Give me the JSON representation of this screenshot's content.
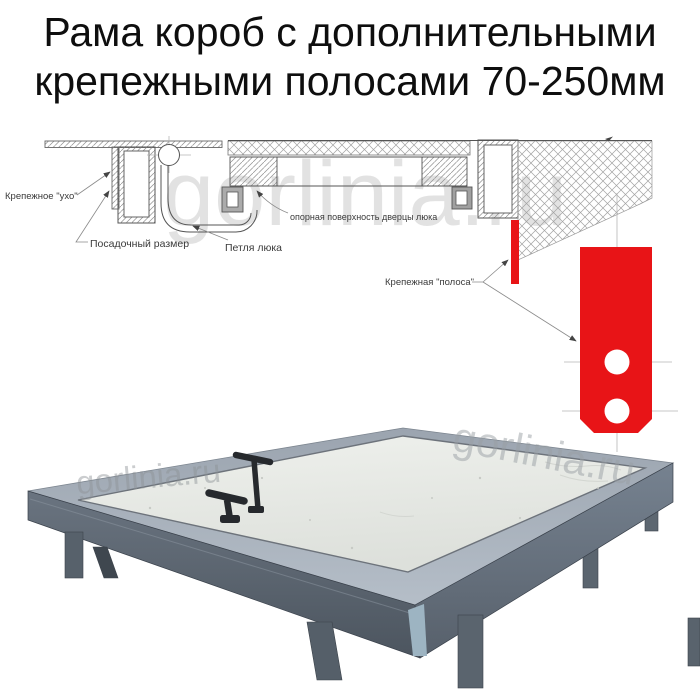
{
  "title": {
    "line1": "Рама короб с дополнительными",
    "line2": "крепежными полосами 70-250мм"
  },
  "watermark": {
    "text": "gorlinia.ru"
  },
  "diagram": {
    "labels": {
      "ear": "Крепежное \"ухо\"",
      "seat": "Посадочный размер",
      "hinge": "Петля люка",
      "support": "опорная поверхность дверцы люка",
      "strip": "Крепежная \"полоса\""
    },
    "colors": {
      "red": "#e81417",
      "line": "#555555",
      "hatch": "#8f8f8f",
      "centerline": "#b5b5b5",
      "label_text": "#3a3a3a"
    }
  },
  "photo": {
    "colors": {
      "rim_top": "#a9b2bc",
      "front_left_face": "#5c6671",
      "front_right_face": "#6b7582",
      "panel": "#e9ebe7",
      "legs": "#57616b",
      "handles": "#26292d",
      "back_edge": "#454d56",
      "corner_cap": "#9db4c2"
    }
  }
}
